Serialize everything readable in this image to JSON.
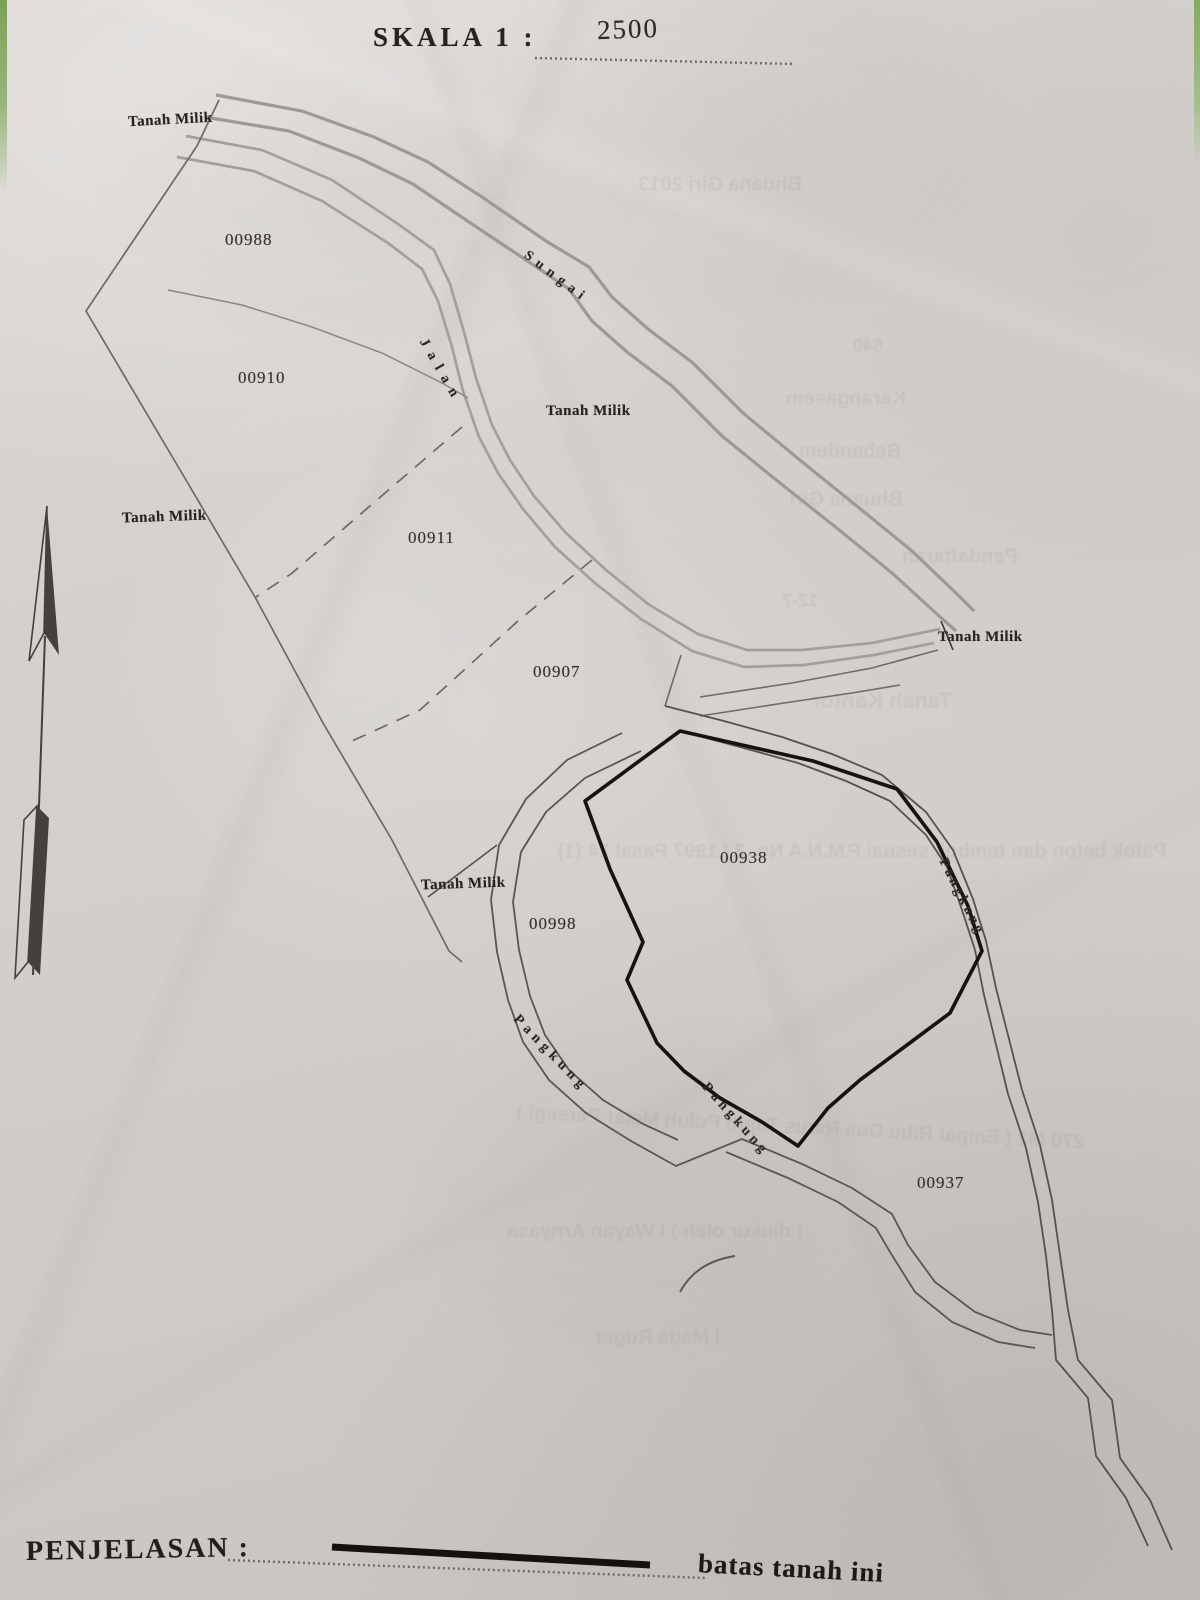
{
  "scale": {
    "label": "SKALA 1 :",
    "value": "2500"
  },
  "legend": {
    "label": "PENJELASAN :",
    "boundary_meaning": "batas tanah ini"
  },
  "map": {
    "owner_label": "Tanah Milik",
    "river_label": "Sungai",
    "road_label": "Jalan",
    "gully_label": "Pangkung",
    "parcels": [
      {
        "id": "00988"
      },
      {
        "id": "00910"
      },
      {
        "id": "00911"
      },
      {
        "id": "00907"
      },
      {
        "id": "00938"
      },
      {
        "id": "00998"
      },
      {
        "id": "00937"
      }
    ],
    "colors": {
      "paper": "#d3cfcb",
      "ink": "#2a2622",
      "bold_boundary": "#15120f",
      "waterway_gray": "#9d9995",
      "edge_green": "#8aa968"
    }
  },
  "bleed_text": [
    {
      "text": "Bhuana Giri 2013"
    },
    {
      "text": "640"
    },
    {
      "text": "Karangasem"
    },
    {
      "text": "Bebandem"
    },
    {
      "text": "Bhuana Giri"
    },
    {
      "text": "Pendaftaran"
    },
    {
      "text": "12-7"
    },
    {
      "text": "Tanah Kantor"
    },
    {
      "text": "Patok beton dan tembok sesuai P.M.N.A No. 3 / 1997 Pasal 24 (1)"
    },
    {
      "text": "270 M2 ( Empat Ribu Dua Ratus Tujuh Puluh Meter Persegi )"
    },
    {
      "text": "( diukur oleh )  I Wayan Arnyasa"
    },
    {
      "text": "I Made Ruget"
    }
  ]
}
